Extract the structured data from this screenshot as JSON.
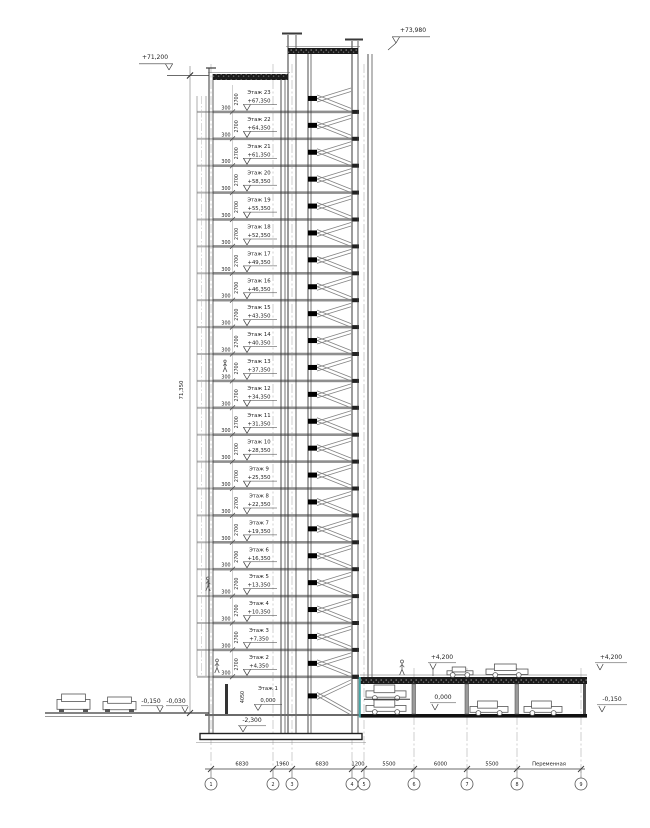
{
  "marks": {
    "roof_left": "+71,200",
    "stair_roof": "+73,980"
  },
  "dims": {
    "total": "71,350",
    "slab": "300",
    "floor_height": "2700",
    "first_floor": "4050",
    "below_slab": "-2,300"
  },
  "floors": [
    {
      "name": "Этаж 23",
      "elev": "+67,350"
    },
    {
      "name": "Этаж 22",
      "elev": "+64,350"
    },
    {
      "name": "Этаж 21",
      "elev": "+61,350"
    },
    {
      "name": "Этаж 20",
      "elev": "+58,350"
    },
    {
      "name": "Этаж 19",
      "elev": "+55,350"
    },
    {
      "name": "Этаж 18",
      "elev": "+52,350"
    },
    {
      "name": "Этаж 17",
      "elev": "+49,350"
    },
    {
      "name": "Этаж 16",
      "elev": "+46,350"
    },
    {
      "name": "Этаж 15",
      "elev": "+43,350"
    },
    {
      "name": "Этаж 14",
      "elev": "+40,350"
    },
    {
      "name": "Этаж 13",
      "elev": "+37,350"
    },
    {
      "name": "Этаж 12",
      "elev": "+34,350"
    },
    {
      "name": "Этаж 11",
      "elev": "+31,350"
    },
    {
      "name": "Этаж 10",
      "elev": "+28,350"
    },
    {
      "name": "Этаж 9",
      "elev": "+25,350"
    },
    {
      "name": "Этаж 8",
      "elev": "+22,350"
    },
    {
      "name": "Этаж 7",
      "elev": "+19,350"
    },
    {
      "name": "Этаж 6",
      "elev": "+16,350"
    },
    {
      "name": "Этаж 5",
      "elev": "+13,350"
    },
    {
      "name": "Этаж 4",
      "elev": "+10,350"
    },
    {
      "name": "Этаж 3",
      "elev": "+7,350"
    },
    {
      "name": "Этаж 2",
      "elev": "+4,350"
    },
    {
      "name": "Этаж 1",
      "elev": "0,000"
    }
  ],
  "site": {
    "left_mark_1": "-0,150",
    "left_mark_2": "-0,030"
  },
  "parking": {
    "roof_elev": "+4,200",
    "floor_elev": "0,000",
    "roof_elev_right": "+4,200",
    "right_low": "-0,150"
  },
  "bottom_dims": [
    "6830",
    "1960",
    "6830",
    "1200",
    "5500",
    "6000",
    "5500",
    "Переменная"
  ],
  "axes": [
    "1",
    "2",
    "3",
    "4",
    "5",
    "6",
    "7",
    "8",
    "9"
  ],
  "colors": {
    "line": "#3a3a3a",
    "slab_gray": "#8f8f8f",
    "hatch_dark": "#1b1b1b",
    "axis_gray": "#b0b0b0",
    "accent_teal": "#46a5a5",
    "stair_gray": "#828282"
  }
}
